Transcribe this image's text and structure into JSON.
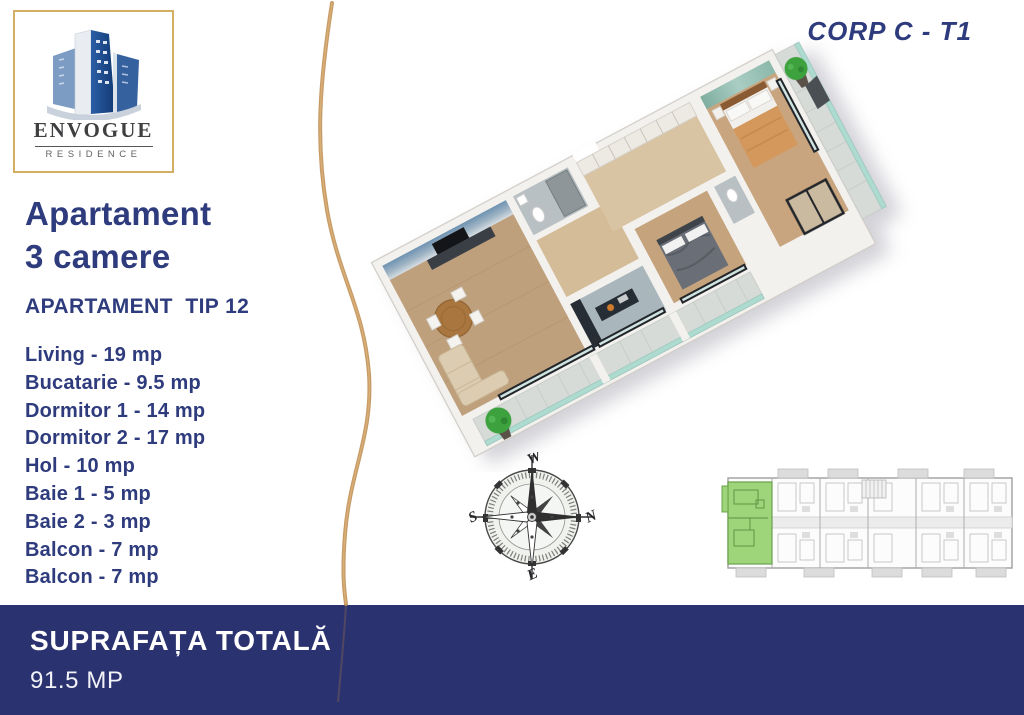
{
  "logo": {
    "brand": "ENVOGUE",
    "subtitle": "RESIDENCE"
  },
  "corp_label": "CORP C - T1",
  "apartment": {
    "title_line1": "Apartament",
    "title_line2": "3 camere",
    "type_label": "APARTAMENT  TIP 12",
    "rooms": [
      "Living - 19 mp",
      "Bucatarie - 9.5 mp",
      "Dormitor 1 - 14 mp",
      "Dormitor 2 - 17 mp",
      "Hol - 10 mp",
      "Baie 1 - 5 mp",
      "Baie 2 - 3 mp",
      "Balcon - 7 mp",
      "Balcon - 7 mp"
    ]
  },
  "footer": {
    "label": "SUPRAFAȚA TOTALĂ",
    "value": "91.5 MP"
  },
  "compass": {
    "north": "N",
    "south": "S",
    "east": "E",
    "west": "W"
  },
  "colors": {
    "navy_text": "#2e3b7d",
    "footer_bar": "#2a326f",
    "gold_accent": "#c2935a",
    "unit_highlight_green": "#9ed47a",
    "balcony_glass_teal": "#aedbd0",
    "wood_floor": "#c5a37d"
  }
}
